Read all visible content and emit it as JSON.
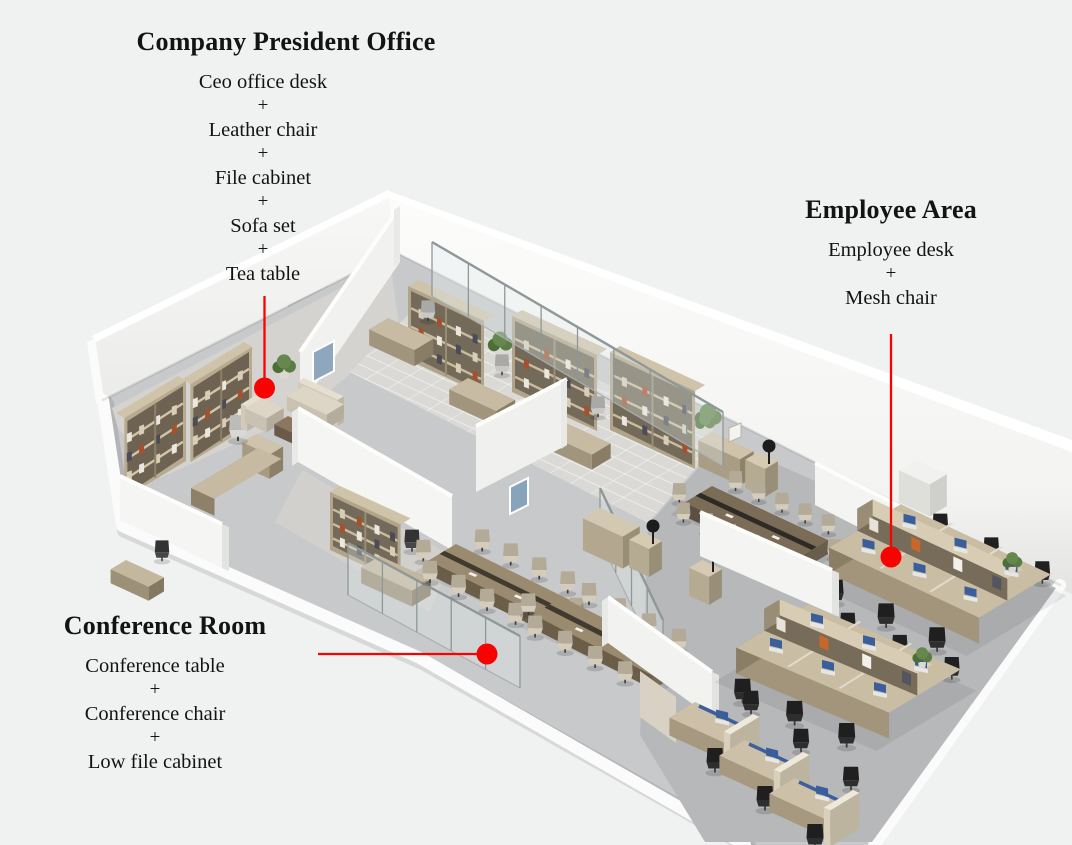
{
  "callouts": {
    "plus": "+",
    "president_office": {
      "title": "Company President Office",
      "items": [
        "Ceo office desk",
        "Leather chair",
        "File cabinet",
        "Sofa set",
        "Tea table"
      ]
    },
    "employee_area": {
      "title": "Employee Area",
      "items": [
        "Employee desk",
        "Mesh chair"
      ]
    },
    "conference_room": {
      "title": "Conference Room",
      "items": [
        "Conference table",
        "Conference chair",
        "Low file cabinet"
      ]
    }
  },
  "markers": {
    "color": "#f70301"
  }
}
